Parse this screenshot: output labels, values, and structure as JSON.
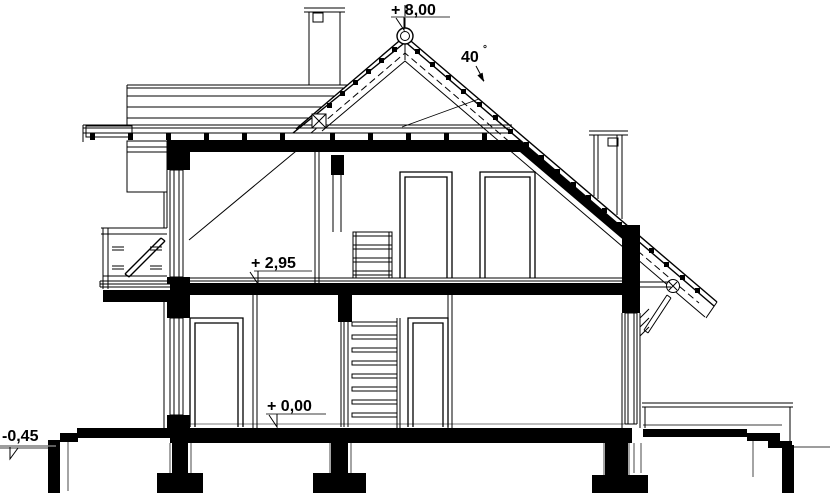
{
  "drawing": {
    "type": "architectural-cross-section",
    "labels": {
      "ridge_level": "+ 8,00",
      "upper_floor_level": "+ 2,95",
      "ground_floor_level": "+ 0,00",
      "terrain_level": "-0,45",
      "roof_angle_value": "40",
      "roof_angle_unit": "°"
    },
    "colors": {
      "line": "#000000",
      "terrain": "#7d7d7d",
      "background": "#ffffff"
    }
  }
}
